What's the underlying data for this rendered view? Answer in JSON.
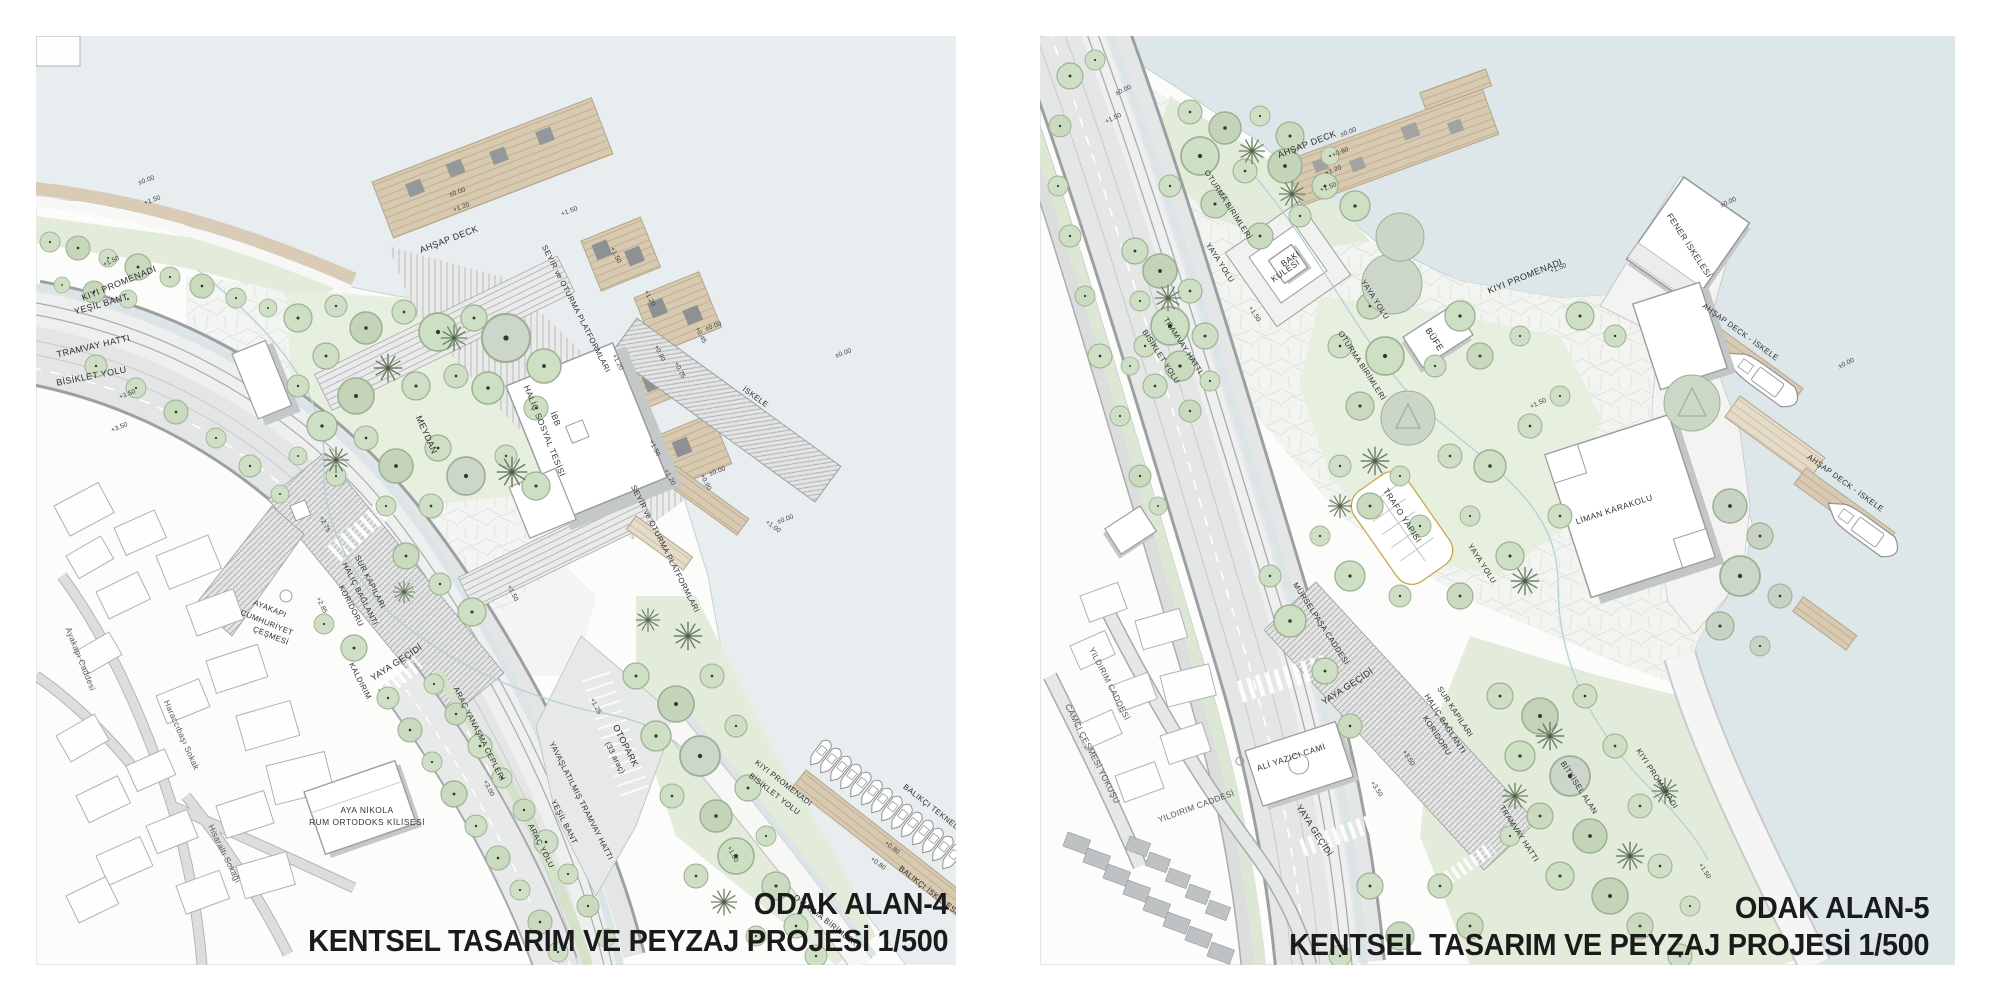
{
  "colors": {
    "water_left": "#e8eeef",
    "water_right": "#dde7e9",
    "land": "#fcfcfb",
    "green": "#e3ecdb",
    "tree": "#cfdfc6",
    "deck_wood": "#d8c9b1",
    "road": "#e4e6e6",
    "title_text": "#1b1b1b"
  },
  "panels": [
    {
      "id": "odak-alan-4",
      "title": "ODAK ALAN-4",
      "subtitle": "KENTSEL TASARIM VE PEYZAJ PROJESİ 1/500",
      "labels": [
        {
          "t": "±0.00",
          "x": 111,
          "y": 146,
          "r": -20,
          "k": "elev"
        },
        {
          "t": "+1.50",
          "x": 117,
          "y": 166,
          "r": -20,
          "k": "elev"
        },
        {
          "t": "+1.50",
          "x": 76,
          "y": 227,
          "r": -25,
          "k": "elev"
        },
        {
          "t": "KIYI PROMENADI",
          "x": 84,
          "y": 250,
          "r": -22
        },
        {
          "t": "YEŞİL BANT",
          "x": 66,
          "y": 271,
          "r": -16
        },
        {
          "t": "TRAMVAY HATTI",
          "x": 58,
          "y": 313,
          "r": -13
        },
        {
          "t": "BİSİKLET YOLU",
          "x": 56,
          "y": 343,
          "r": -11
        },
        {
          "t": "+3.50",
          "x": 92,
          "y": 360,
          "r": -22,
          "k": "elev"
        },
        {
          "t": "+3.50",
          "x": 84,
          "y": 393,
          "r": -22,
          "k": "elev"
        },
        {
          "t": "±0.00",
          "x": 422,
          "y": 158,
          "r": -20,
          "k": "elev"
        },
        {
          "t": "+1.20",
          "x": 426,
          "y": 173,
          "r": -20,
          "k": "elev"
        },
        {
          "t": "AHŞAP DECK",
          "x": 414,
          "y": 206,
          "r": -21
        },
        {
          "t": "+1.50",
          "x": 534,
          "y": 177,
          "r": -21,
          "k": "elev"
        },
        {
          "t": "SEYİR ve OTURMA PLATFORMLARI",
          "x": 538,
          "y": 274,
          "r": 63,
          "k": "sm"
        },
        {
          "t": "+1.50",
          "x": 578,
          "y": 220,
          "r": 63,
          "k": "elev"
        },
        {
          "t": "+1.20",
          "x": 612,
          "y": 263,
          "r": 63,
          "k": "elev"
        },
        {
          "t": "+1.20",
          "x": 580,
          "y": 327,
          "r": 63,
          "k": "elev"
        },
        {
          "t": "±0.00",
          "x": 678,
          "y": 292,
          "r": -20,
          "k": "elev"
        },
        {
          "t": "+0.45",
          "x": 663,
          "y": 300,
          "r": 63,
          "k": "elev"
        },
        {
          "t": "+0.90",
          "x": 622,
          "y": 318,
          "r": 63,
          "k": "elev"
        },
        {
          "t": "+0.75",
          "x": 642,
          "y": 335,
          "r": 63,
          "k": "elev"
        },
        {
          "t": "İSKELE",
          "x": 718,
          "y": 363,
          "r": 36,
          "k": "sm"
        },
        {
          "t": "±0.00",
          "x": 808,
          "y": 319,
          "r": -20,
          "k": "elev"
        },
        {
          "t": "+1.50",
          "x": 617,
          "y": 413,
          "r": 63,
          "k": "elev"
        },
        {
          "t": "+1.20",
          "x": 632,
          "y": 442,
          "r": 63,
          "k": "elev"
        },
        {
          "t": "±0.00",
          "x": 682,
          "y": 437,
          "r": -20,
          "k": "elev"
        },
        {
          "t": "+0.90",
          "x": 668,
          "y": 447,
          "r": 63,
          "k": "elev"
        },
        {
          "t": "±0.00",
          "x": 750,
          "y": 485,
          "r": -20,
          "k": "elev"
        },
        {
          "t": "+1.00",
          "x": 736,
          "y": 492,
          "r": 36,
          "k": "elev"
        },
        {
          "t": "SEYİR ve OTURMA PLATFORMLARI",
          "x": 627,
          "y": 514,
          "r": 63,
          "k": "sm"
        },
        {
          "t": "İBB",
          "x": 517,
          "y": 384,
          "r": 68,
          "k": "bldg"
        },
        {
          "t": "HALİÇ SOSYAL TESİSİ",
          "x": 506,
          "y": 396,
          "r": 68,
          "k": "bldg"
        },
        {
          "t": "MEYDAN",
          "x": 388,
          "y": 400,
          "r": 66
        },
        {
          "t": "+2.75",
          "x": 287,
          "y": 489,
          "r": 64,
          "k": "elev"
        },
        {
          "t": "SUR KAPILARI",
          "x": 332,
          "y": 547,
          "r": 63,
          "k": "sm"
        },
        {
          "t": "HALİÇ BAĞLANTI",
          "x": 322,
          "y": 559,
          "r": 63,
          "k": "sm"
        },
        {
          "t": "KORİDORU",
          "x": 313,
          "y": 571,
          "r": 63,
          "k": "sm"
        },
        {
          "t": "+2.85",
          "x": 284,
          "y": 570,
          "r": 64,
          "k": "elev"
        },
        {
          "t": "AYAKAPI",
          "x": 233,
          "y": 575,
          "r": 22,
          "k": "sm"
        },
        {
          "t": "CUMHURİYET",
          "x": 230,
          "y": 589,
          "r": 22,
          "k": "sm"
        },
        {
          "t": "ÇEŞMESİ",
          "x": 234,
          "y": 602,
          "r": 22,
          "k": "sm"
        },
        {
          "t": "YAYA GEÇİDİ",
          "x": 362,
          "y": 629,
          "r": -33
        },
        {
          "t": "KALDIRIM",
          "x": 322,
          "y": 646,
          "r": 63,
          "k": "sm"
        },
        {
          "t": "Ayakapı Caddesi",
          "x": 42,
          "y": 624,
          "r": 68,
          "k": "street"
        },
        {
          "t": "Haraccıbaşı Sokak",
          "x": 143,
          "y": 700,
          "r": 66,
          "k": "street"
        },
        {
          "t": "Hisaraltı Sokağı",
          "x": 186,
          "y": 819,
          "r": 64,
          "k": "street"
        },
        {
          "t": "AYA NİKOLA",
          "x": 331,
          "y": 777,
          "r": 0,
          "k": "bldg"
        },
        {
          "t": "RUM ORTODOKS KİLİSESİ",
          "x": 331,
          "y": 789,
          "r": 0,
          "k": "bldg"
        },
        {
          "t": "ARAÇ YANAŞMA CEPLERİ",
          "x": 441,
          "y": 699,
          "r": 63,
          "k": "sm"
        },
        {
          "t": "+3.00",
          "x": 451,
          "y": 753,
          "r": 63,
          "k": "elev"
        },
        {
          "t": "ARAÇ YOLU",
          "x": 503,
          "y": 811,
          "r": 63,
          "k": "sm"
        },
        {
          "t": "YEŞİL BANT",
          "x": 526,
          "y": 787,
          "r": 63,
          "k": "sm"
        },
        {
          "t": "YAVAŞLATILMIŞ TRAMVAY HATTI",
          "x": 543,
          "y": 766,
          "r": 63,
          "k": "sm"
        },
        {
          "t": "OTOPARK",
          "x": 587,
          "y": 711,
          "r": 63
        },
        {
          "t": "(33 araç)",
          "x": 577,
          "y": 723,
          "r": 63,
          "k": "sm"
        },
        {
          "t": "+1.25",
          "x": 558,
          "y": 671,
          "r": 63,
          "k": "elev"
        },
        {
          "t": "+1.50",
          "x": 475,
          "y": 558,
          "r": 63,
          "k": "elev"
        },
        {
          "t": "+1.00",
          "x": 695,
          "y": 819,
          "r": 63,
          "k": "elev"
        },
        {
          "t": "KIYI PROMENADI",
          "x": 746,
          "y": 749,
          "r": 38,
          "k": "sm"
        },
        {
          "t": "BİSİKLET YOLU",
          "x": 737,
          "y": 760,
          "r": 38,
          "k": "sm"
        },
        {
          "t": "BALIKÇI TEKNELERİ",
          "x": 899,
          "y": 777,
          "r": 38,
          "k": "sm"
        },
        {
          "t": "BALIKÇI İSKELESİ",
          "x": 891,
          "y": 856,
          "r": 38,
          "k": "sm"
        },
        {
          "t": "+0.80",
          "x": 855,
          "y": 813,
          "r": 38,
          "k": "elev"
        },
        {
          "t": "+0.80",
          "x": 841,
          "y": 829,
          "r": 38,
          "k": "elev"
        },
        {
          "t": "OTURMA BİRİMLERİ",
          "x": 789,
          "y": 887,
          "r": 38,
          "k": "sm"
        }
      ]
    },
    {
      "id": "odak-alan-5",
      "title": "ODAK ALAN-5",
      "subtitle": "KENTSEL TASARIM VE PEYZAJ PROJESİ 1/500",
      "labels": [
        {
          "t": "±0.00",
          "x": 84,
          "y": 56,
          "r": -25,
          "k": "elev"
        },
        {
          "t": "+1.50",
          "x": 74,
          "y": 84,
          "r": -25,
          "k": "elev"
        },
        {
          "t": "AHŞAP DECK",
          "x": 268,
          "y": 111,
          "r": -21
        },
        {
          "t": "±0.00",
          "x": 309,
          "y": 98,
          "r": -21,
          "k": "elev"
        },
        {
          "t": "+0.90",
          "x": 301,
          "y": 118,
          "r": -21,
          "k": "elev"
        },
        {
          "t": "+1.20",
          "x": 294,
          "y": 136,
          "r": -21,
          "k": "elev"
        },
        {
          "t": "+1.50",
          "x": 289,
          "y": 153,
          "r": -21,
          "k": "elev"
        },
        {
          "t": "OTURMA BİRİMLERİ",
          "x": 186,
          "y": 170,
          "r": 57,
          "k": "sm"
        },
        {
          "t": "YAYA YOLU",
          "x": 178,
          "y": 228,
          "r": 57,
          "k": "sm"
        },
        {
          "t": "BAKI",
          "x": 252,
          "y": 225,
          "r": -35,
          "k": "bldg"
        },
        {
          "t": "KULESİ",
          "x": 247,
          "y": 237,
          "r": -35,
          "k": "bldg"
        },
        {
          "t": "YAYA YOLU",
          "x": 333,
          "y": 265,
          "r": 57,
          "k": "sm"
        },
        {
          "t": "+1.50",
          "x": 213,
          "y": 279,
          "r": 57,
          "k": "elev"
        },
        {
          "t": "BÜFE",
          "x": 392,
          "y": 305,
          "r": 57
        },
        {
          "t": "TRAMVAY HATTI",
          "x": 141,
          "y": 311,
          "r": 57,
          "k": "sm"
        },
        {
          "t": "BİSİKLET YOLU",
          "x": 119,
          "y": 322,
          "r": 57,
          "k": "sm"
        },
        {
          "t": "KIYI PROMENADI",
          "x": 486,
          "y": 243,
          "r": -22
        },
        {
          "t": "+1.50",
          "x": 519,
          "y": 234,
          "r": -22,
          "k": "elev"
        },
        {
          "t": "FENER İSKELESİ",
          "x": 647,
          "y": 211,
          "r": 57,
          "k": "bldg"
        },
        {
          "t": "±0.00",
          "x": 689,
          "y": 168,
          "r": -25,
          "k": "elev"
        },
        {
          "t": "AHŞAP DECK - İSKELE",
          "x": 699,
          "y": 298,
          "r": 36,
          "k": "sm"
        },
        {
          "t": "±0.00",
          "x": 807,
          "y": 329,
          "r": -25,
          "k": "elev"
        },
        {
          "t": "+1.50",
          "x": 499,
          "y": 369,
          "r": -25,
          "k": "elev"
        },
        {
          "t": "OTURMA BİRİMLERİ",
          "x": 320,
          "y": 331,
          "r": 57,
          "k": "sm"
        },
        {
          "t": "TRAFO YAPISI",
          "x": 360,
          "y": 481,
          "r": 57,
          "k": "bldg"
        },
        {
          "t": "YAYA YOLU",
          "x": 440,
          "y": 529,
          "r": 57,
          "k": "sm"
        },
        {
          "t": "LİMAN KARAKOLU",
          "x": 575,
          "y": 476,
          "r": -18,
          "k": "bldg"
        },
        {
          "t": "AHŞAP DECK - İSKELE",
          "x": 804,
          "y": 449,
          "r": 36,
          "k": "sm"
        },
        {
          "t": "MÜRSELPAŞA CADDESİ",
          "x": 279,
          "y": 589,
          "r": 57,
          "k": "sm"
        },
        {
          "t": "YAYA GEÇİDİ",
          "x": 309,
          "y": 653,
          "r": -33
        },
        {
          "t": "SUR KAPILARI",
          "x": 413,
          "y": 677,
          "r": 57,
          "k": "sm"
        },
        {
          "t": "HALİÇ BAĞLANTI",
          "x": 403,
          "y": 689,
          "r": 57,
          "k": "sm"
        },
        {
          "t": "KORİDORU",
          "x": 395,
          "y": 701,
          "r": 57,
          "k": "sm"
        },
        {
          "t": "ALİ YAZICI CAMİ",
          "x": 252,
          "y": 724,
          "r": -18,
          "k": "bldg"
        },
        {
          "t": "YILDIRIM CADDESİ",
          "x": 67,
          "y": 649,
          "r": 63,
          "k": "street"
        },
        {
          "t": "CAMCI ÇEŞMESİ YOKUŞU",
          "x": 50,
          "y": 719,
          "r": 63,
          "k": "street"
        },
        {
          "t": "YILDIRIM CADDESİ",
          "x": 157,
          "y": 773,
          "r": -20,
          "k": "street"
        },
        {
          "t": "+3.50",
          "x": 367,
          "y": 723,
          "r": 57,
          "k": "elev"
        },
        {
          "t": "+3.50",
          "x": 335,
          "y": 754,
          "r": 57,
          "k": "elev"
        },
        {
          "t": "YAYA GEÇİDİ",
          "x": 272,
          "y": 796,
          "r": 57
        },
        {
          "t": "BİTKİSEL ALAN",
          "x": 537,
          "y": 753,
          "r": 57,
          "k": "sm"
        },
        {
          "t": "KIYI PROMENADI",
          "x": 615,
          "y": 744,
          "r": 57,
          "k": "sm"
        },
        {
          "t": "TRAMVAY HATTI",
          "x": 477,
          "y": 799,
          "r": 57,
          "k": "sm"
        },
        {
          "t": "+1.50",
          "x": 663,
          "y": 836,
          "r": 57,
          "k": "elev"
        }
      ]
    }
  ]
}
